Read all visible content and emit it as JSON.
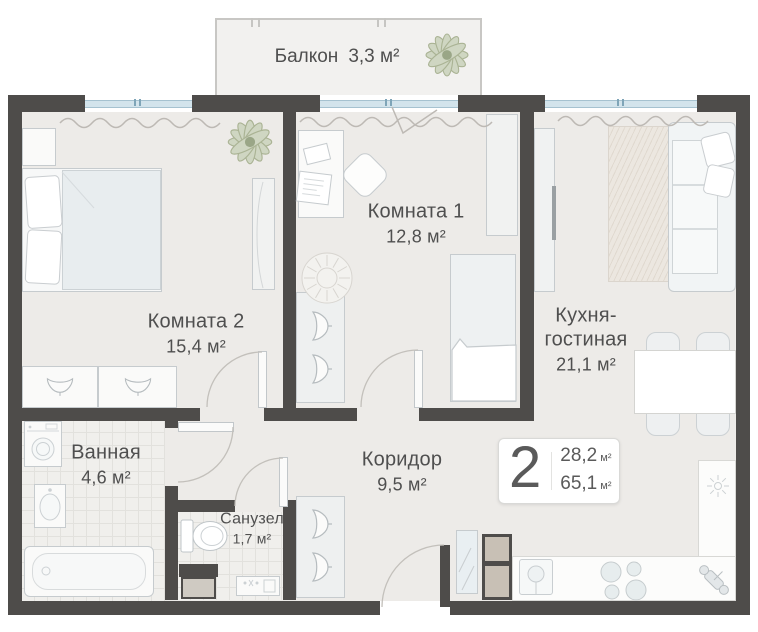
{
  "rooms": {
    "balcony": {
      "name": "Балкон",
      "area": "3,3 м²"
    },
    "room1": {
      "name": "Комната 1",
      "area": "12,8 м²"
    },
    "room2": {
      "name": "Комната 2",
      "area": "15,4 м²"
    },
    "kitchen": {
      "name": "Кухня-гостиная",
      "area": "21,1 м²"
    },
    "bathroom": {
      "name": "Ванная",
      "area": "4,6 м²"
    },
    "wc": {
      "name": "Санузел",
      "area": "1,7 м²"
    },
    "corridor": {
      "name": "Коридор",
      "area": "9,5 м²"
    }
  },
  "badge": {
    "rooms_count": "2",
    "area_living": "28,2",
    "area_total": "65,1",
    "unit": "м²"
  },
  "icons": [
    "plant-icon",
    "hanger-icon",
    "toilet-icon",
    "washer-icon",
    "stove-burners-icon",
    "sink-icon",
    "hob-icon",
    "faucet-icon",
    "rug-icon",
    "curtain-line",
    "door-arc"
  ],
  "colors": {
    "wall": "#4e4c4a",
    "floor": "#edebe8",
    "tile_floor": "#f0efec",
    "window_glass": "#d3e4ec",
    "furniture_outline": "#c6cbce",
    "plant": "#cfd6c2",
    "appliance_tan": "#c8c0b5",
    "text": "#4f4f4f"
  }
}
